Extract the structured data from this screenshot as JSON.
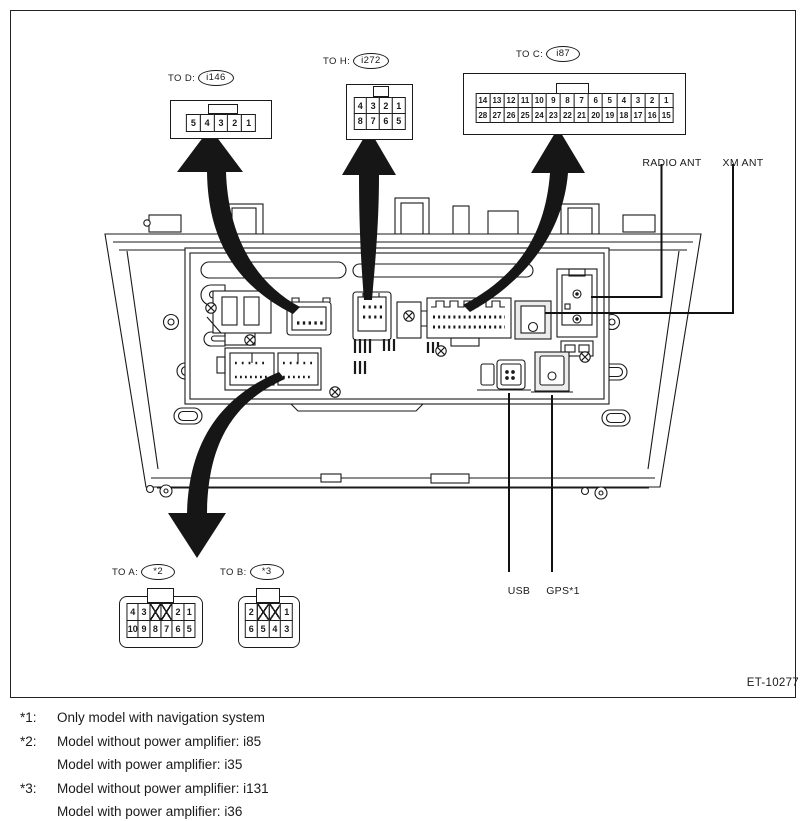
{
  "figure": {
    "id": "ET-10277"
  },
  "connector_diagrams": {
    "d": {
      "to_label": "TO D:",
      "ref": "i146",
      "rows": [
        [
          "5",
          "4",
          "3",
          "2",
          "1"
        ]
      ]
    },
    "h": {
      "to_label": "TO H:",
      "ref": "i272",
      "rows": [
        [
          "4",
          "3",
          "2",
          "1"
        ],
        [
          "8",
          "7",
          "6",
          "5"
        ]
      ]
    },
    "c": {
      "to_label": "TO C:",
      "ref": "i87",
      "rows": [
        [
          "14",
          "13",
          "12",
          "11",
          "10",
          "9",
          "8",
          "7",
          "6",
          "5",
          "4",
          "3",
          "2",
          "1"
        ],
        [
          "28",
          "27",
          "26",
          "25",
          "24",
          "23",
          "22",
          "21",
          "20",
          "19",
          "18",
          "17",
          "16",
          "15"
        ]
      ]
    },
    "a": {
      "to_label": "TO A:",
      "ref": "*2",
      "rows": [
        [
          "4",
          "3",
          "X",
          "X",
          "2",
          "1"
        ],
        [
          "10",
          "9",
          "8",
          "7",
          "6",
          "5"
        ]
      ]
    },
    "b": {
      "to_label": "TO B:",
      "ref": "*3",
      "rows": [
        [
          "2",
          "X",
          "X",
          "1"
        ],
        [
          "6",
          "5",
          "4",
          "3"
        ]
      ]
    }
  },
  "unit_labels": {
    "radio_ant": "RADIO ANT",
    "xm_ant": "XM ANT",
    "usb": "USB",
    "gps": "GPS*1"
  },
  "footnotes": [
    {
      "marker": "*1:",
      "lines": [
        "Only model with navigation system"
      ]
    },
    {
      "marker": "*2:",
      "lines": [
        "Model without power amplifier: i85",
        "Model with power amplifier: i35"
      ]
    },
    {
      "marker": "*3:",
      "lines": [
        "Model without power amplifier: i131",
        "Model with power amplifier: i36"
      ]
    }
  ]
}
